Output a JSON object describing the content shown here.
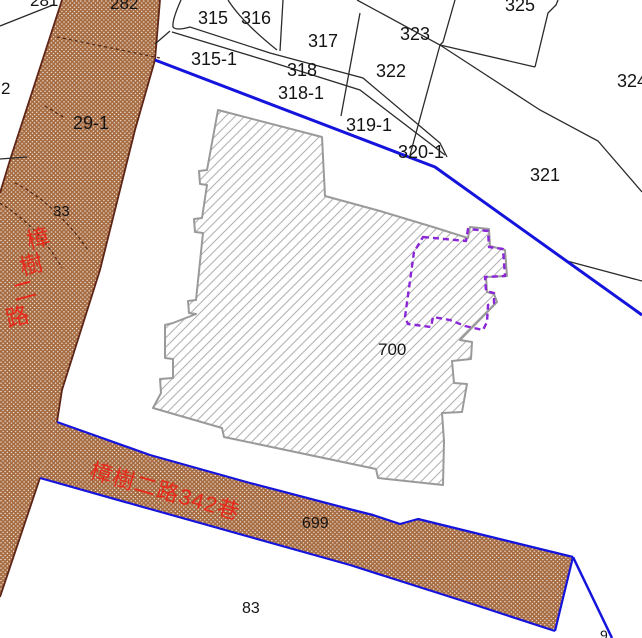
{
  "map": {
    "colors": {
      "road-fill": "#a66b40",
      "road-edge": "#5e2517",
      "road-dash": "#4a2413",
      "blue": "#1414dc",
      "line": "#2b2b2b",
      "outline": "#9a9a9a",
      "hatch": "#b3b3b3",
      "purple": "#8a26d8",
      "label": "#141414",
      "street": "#e8281a"
    },
    "labels": [
      {
        "text": "281",
        "x": 30,
        "y": -8,
        "size": 17
      },
      {
        "text": "282",
        "x": 110,
        "y": -5,
        "size": 17
      },
      {
        "text": "2",
        "x": 1,
        "y": 80,
        "size": 17
      },
      {
        "text": "29-1",
        "x": 73,
        "y": 114,
        "size": 18
      },
      {
        "text": "33",
        "x": 53,
        "y": 204,
        "size": 15
      },
      {
        "text": "315",
        "x": 198,
        "y": 9,
        "size": 18
      },
      {
        "text": "316",
        "x": 241,
        "y": 9,
        "size": 18
      },
      {
        "text": "315-1",
        "x": 191,
        "y": 50,
        "size": 18
      },
      {
        "text": "317",
        "x": 308,
        "y": 32,
        "size": 18
      },
      {
        "text": "318",
        "x": 287,
        "y": 61,
        "size": 18
      },
      {
        "text": "318-1",
        "x": 278,
        "y": 84,
        "size": 18
      },
      {
        "text": "319-1",
        "x": 346,
        "y": 116,
        "size": 18
      },
      {
        "text": "320-1",
        "x": 398,
        "y": 143,
        "size": 18
      },
      {
        "text": "322",
        "x": 376,
        "y": 62,
        "size": 18
      },
      {
        "text": "323",
        "x": 400,
        "y": 25,
        "size": 18
      },
      {
        "text": "325",
        "x": 505,
        "y": -4,
        "size": 18
      },
      {
        "text": "324",
        "x": 617,
        "y": 72,
        "size": 18
      },
      {
        "text": "321",
        "x": 530,
        "y": 166,
        "size": 18
      },
      {
        "text": "700",
        "x": 378,
        "y": 341,
        "size": 17
      },
      {
        "text": "699",
        "x": 302,
        "y": 516,
        "size": 16
      },
      {
        "text": "83",
        "x": 242,
        "y": 601,
        "size": 16
      },
      {
        "text": "9",
        "x": 600,
        "y": 628,
        "size": 14
      },
      {
        "text": "樟樹二路",
        "type": "street-vertical",
        "x": 24,
        "y": 230,
        "size": 23,
        "rot": -15,
        "dx": -7,
        "dy": 26,
        "color": "#e8281a"
      },
      {
        "text": "樟樹二路342巷",
        "type": "street",
        "x": 94,
        "y": 459,
        "size": 22,
        "rot": 16,
        "color": "#e8281a"
      }
    ]
  }
}
